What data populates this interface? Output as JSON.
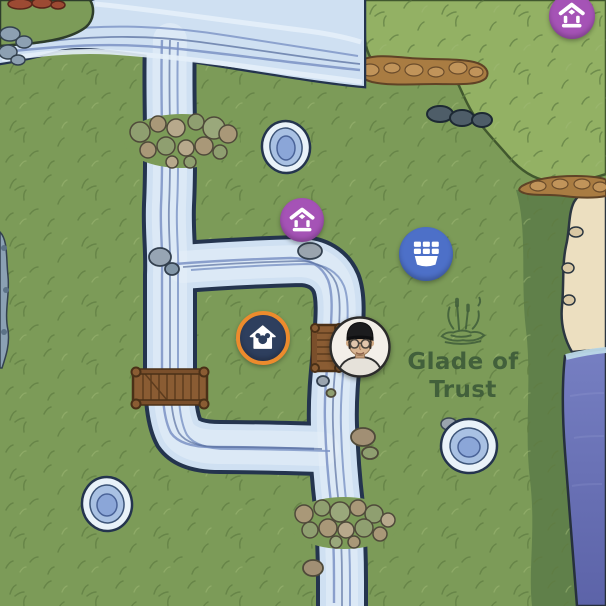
{
  "map": {
    "region": {
      "name": "Glade of Trust",
      "icon": "swamp-cattails-icon",
      "label_color": "#3e5b39"
    },
    "markers": [
      {
        "name": "character-home-marker-far",
        "icon": "house-shrine-icon",
        "color": "#a553b6",
        "x": 572,
        "y": 16,
        "r": 23
      },
      {
        "name": "character-home-marker-near",
        "icon": "house-shrine-icon",
        "color": "#a553b6",
        "x": 302,
        "y": 220,
        "r": 22
      },
      {
        "name": "market-stall-marker",
        "icon": "market-stall-icon",
        "color": "#4d70c8",
        "x": 426,
        "y": 254,
        "r": 27
      },
      {
        "name": "player-home-marker",
        "icon": "mickey-house-icon",
        "color": "#2e3f5e",
        "ring_color": "#ec8b2d",
        "x": 263,
        "y": 338,
        "r": 27
      },
      {
        "name": "player-avatar-marker",
        "icon": "player-portrait-beanie-glasses",
        "x": 360,
        "y": 347,
        "r": 31
      }
    ],
    "terrain": {
      "grass": "#7c9b58",
      "grass_light_plateau": "#93b164",
      "grass_dark_shore": "#60804a",
      "river_fill": "#cfe0f2",
      "river_outline": "#24344e",
      "sand": "#ecdfc0",
      "sea": "#6d76b9",
      "bridge_wood": "#8a5c33",
      "ledge_rock": "#a97c42"
    },
    "features": [
      "river-network",
      "wide-river-north",
      "wooden-bridge-west",
      "wooden-bridge-center",
      "stone-crossing-north",
      "stone-crossing-south",
      "pond-north",
      "pond-east",
      "pond-southwest",
      "plateau-northeast",
      "beach-east",
      "sea-southeast"
    ]
  }
}
